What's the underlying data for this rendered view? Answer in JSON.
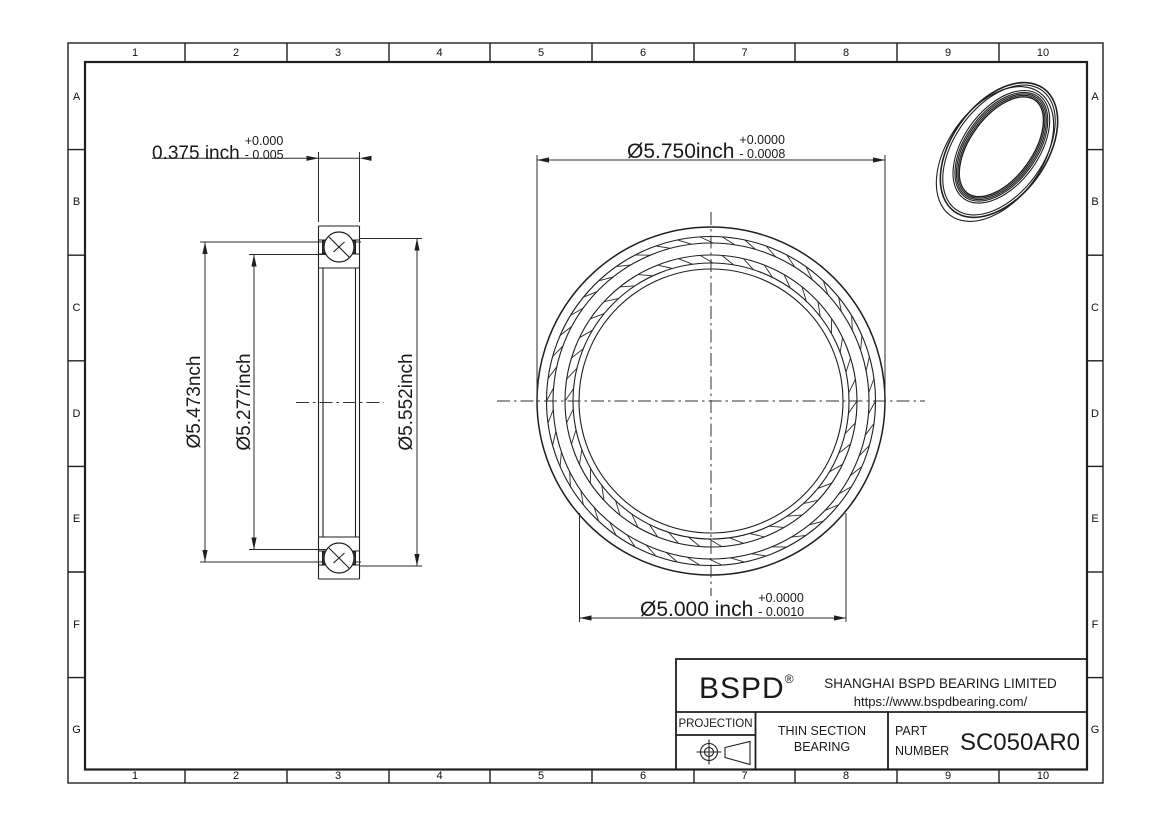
{
  "grid": {
    "cols": [
      "1",
      "2",
      "3",
      "4",
      "5",
      "6",
      "7",
      "8",
      "9",
      "10"
    ],
    "rows": [
      "A",
      "B",
      "C",
      "D",
      "E",
      "F",
      "G"
    ]
  },
  "views": {
    "section": {
      "dim_width": {
        "value": "0.375 inch",
        "tol_plus": "+0.000",
        "tol_minus": "- 0.005"
      },
      "dim_left_outer": "Ø5.473nch",
      "dim_left_inner": "Ø5.277inch",
      "dim_right": "Ø5.552inch"
    },
    "front": {
      "dim_od": {
        "value": "Ø5.750inch",
        "tol_plus": "+0.0000",
        "tol_minus": "- 0.0008"
      },
      "dim_bore": {
        "value": "Ø5.000 inch",
        "tol_plus": "+0.0000",
        "tol_minus": "- 0.0010"
      }
    }
  },
  "title_block": {
    "logo": "BSPD",
    "logo_reg": "®",
    "company": "SHANGHAI BSPD BEARING LIMITED",
    "website": "https://www.bspdbearing.com/",
    "projection_label": "PROJECTION",
    "product_line1": "THIN SECTION",
    "product_line2": "BEARING",
    "part_label_line1": "PART",
    "part_label_line2": "NUMBER",
    "part_number": "SC050AR0"
  },
  "colors": {
    "line": "#1f1f1f",
    "background": "#ffffff",
    "seal_fill": "#3a3a3a"
  }
}
